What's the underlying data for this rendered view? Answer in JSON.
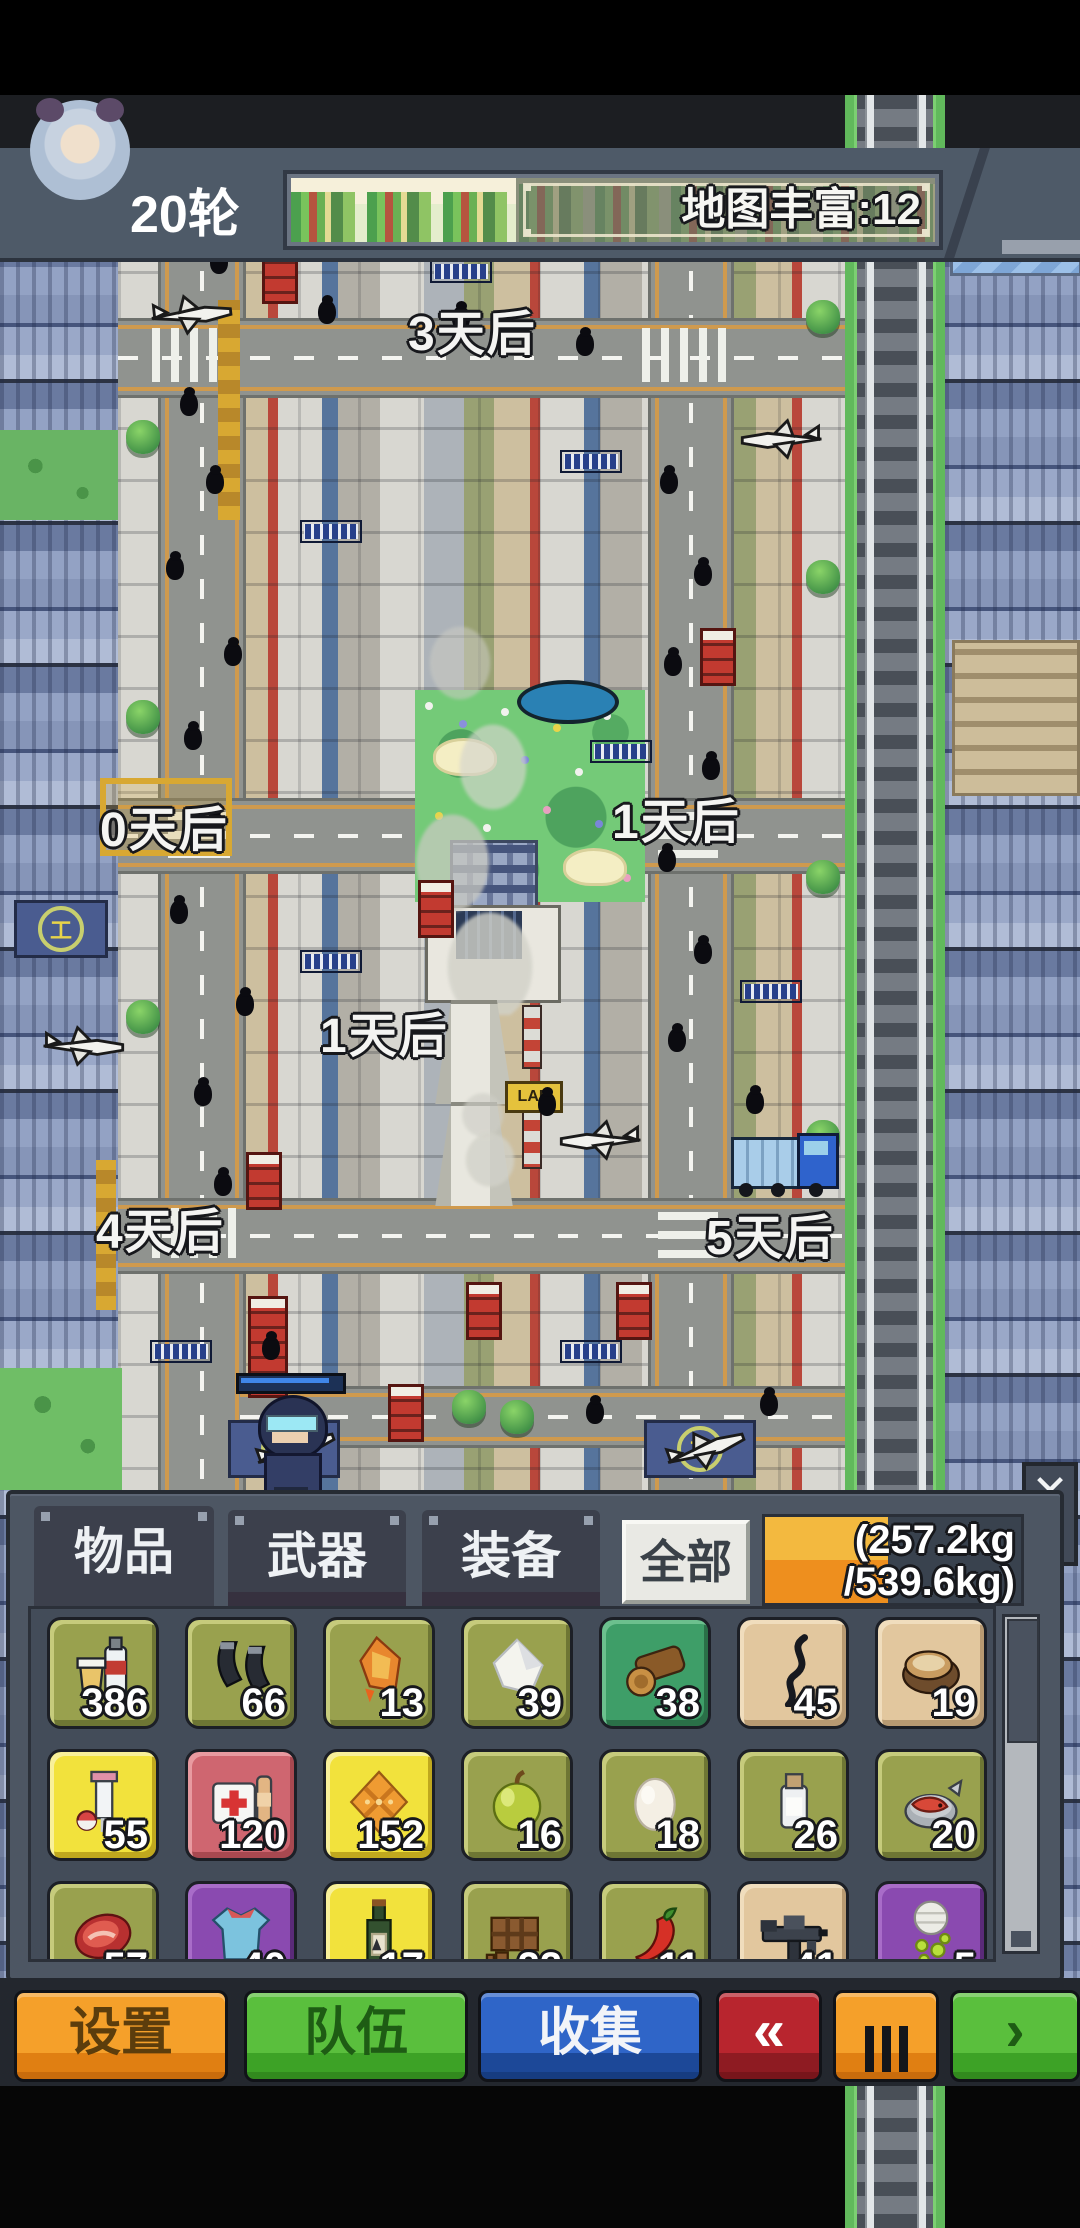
{
  "header": {
    "round_label": "20轮",
    "map_bar_label": "地图丰富:12",
    "map_bar_fill_percent": 35
  },
  "map": {
    "labels": [
      {
        "text": "3天后"
      },
      {
        "text": "0天后"
      },
      {
        "text": "1天后"
      },
      {
        "text": "1天后"
      },
      {
        "text": "4天后"
      },
      {
        "text": "5天后"
      }
    ],
    "lab_sign": "LAB",
    "helipad_symbol": "工"
  },
  "inventory": {
    "tabs": [
      {
        "label": "物品",
        "active": true
      },
      {
        "label": "武器",
        "active": false
      },
      {
        "label": "装备",
        "active": false
      }
    ],
    "filter_button": "全部",
    "close_label": "✕",
    "weight": {
      "line1": "(257.2kg",
      "line2": "/539.6kg)",
      "current_kg": 257.2,
      "capacity_kg": 539.6,
      "fill_percent": 48
    },
    "items": [
      {
        "icon": "water-bottles",
        "count": "386",
        "slot": "olive"
      },
      {
        "icon": "gun-magazines",
        "count": "66",
        "slot": "olive"
      },
      {
        "icon": "torch",
        "count": "13",
        "slot": "olive"
      },
      {
        "icon": "salt-crystal",
        "count": "39",
        "slot": "olive"
      },
      {
        "icon": "wood-logs",
        "count": "38",
        "slot": "green"
      },
      {
        "icon": "rope-wire",
        "count": "45",
        "slot": "tan"
      },
      {
        "icon": "canned-bread",
        "count": "19",
        "slot": "tan"
      },
      {
        "icon": "syringe",
        "count": "55",
        "slot": "yellow"
      },
      {
        "icon": "first-aid-kit",
        "count": "120",
        "slot": "red"
      },
      {
        "icon": "cracker",
        "count": "152",
        "slot": "yellow"
      },
      {
        "icon": "apple",
        "count": "16",
        "slot": "olive"
      },
      {
        "icon": "egg",
        "count": "18",
        "slot": "olive"
      },
      {
        "icon": "medicine-bottle",
        "count": "26",
        "slot": "olive"
      },
      {
        "icon": "canned-fish",
        "count": "20",
        "slot": "olive"
      },
      {
        "icon": "meat",
        "count": "57",
        "slot": "olive"
      },
      {
        "icon": "shirt",
        "count": "40",
        "slot": "purple"
      },
      {
        "icon": "wine-bottle",
        "count": "17",
        "slot": "yellow"
      },
      {
        "icon": "chocolate",
        "count": "22",
        "slot": "olive"
      },
      {
        "icon": "chili",
        "count": "11",
        "slot": "olive"
      },
      {
        "icon": "submachine-gun",
        "count": "41",
        "slot": "tan"
      },
      {
        "icon": "gadget",
        "count": "5",
        "slot": "purple"
      }
    ]
  },
  "action_bar": {
    "buttons": [
      {
        "label": "设置",
        "color": "orange"
      },
      {
        "label": "队伍",
        "color": "green"
      },
      {
        "label": "收集",
        "color": "blue"
      },
      {
        "glyph": "«",
        "color": "red"
      },
      {
        "glyph": "Ⅲ",
        "color": "orange"
      },
      {
        "glyph": "›",
        "color": "green"
      }
    ]
  },
  "colors": {
    "accent_orange": "#f5a02a",
    "accent_green": "#5abf3d",
    "accent_blue": "#2f65c8",
    "accent_red": "#b8252e",
    "weight_fill_top": "#f3b93f",
    "weight_fill_bottom": "#ee8f1e",
    "panel_slate": "#4d5663",
    "header_slate": "#4e5a68"
  }
}
